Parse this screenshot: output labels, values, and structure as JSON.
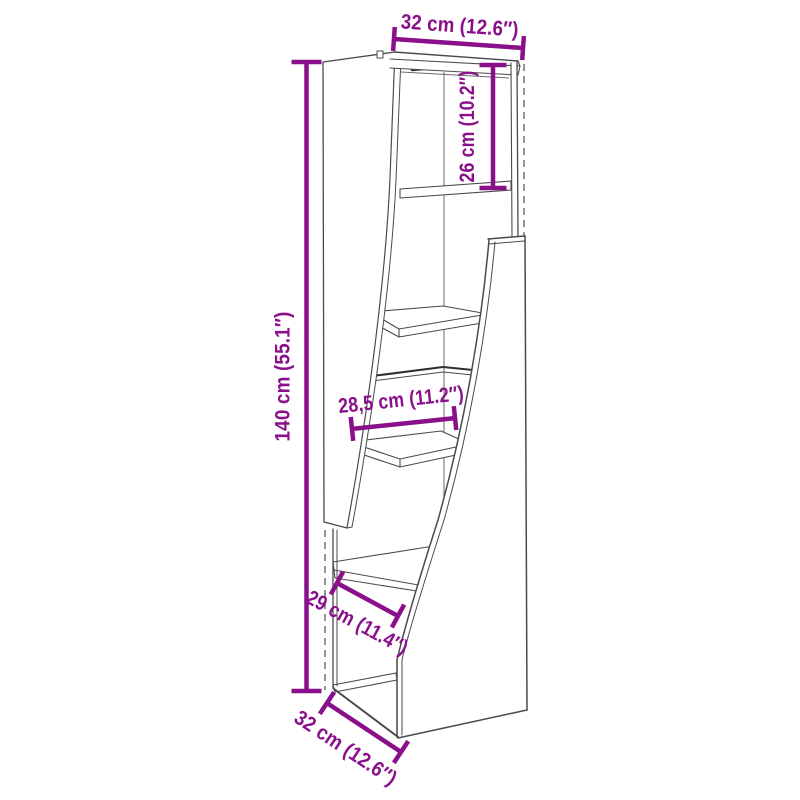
{
  "image_type": "furniture-dimension-diagram",
  "subject": "corner-shelf-unit-line-drawing",
  "colors": {
    "dimension": "#8A0F8A",
    "structure": "#4A4A4A",
    "background": "#FFFFFF"
  },
  "dimensions": {
    "top_width": {
      "label": "32 cm (12.6″)",
      "cm": "32",
      "inches": "12.6"
    },
    "upper_height": {
      "label": "26 cm (10.2″)",
      "cm": "26",
      "inches": "10.2"
    },
    "total_height": {
      "label": "140 cm (55.1″)",
      "cm": "140",
      "inches": "55.1"
    },
    "middle_shelf": {
      "label": "28,5 cm (11.2″)",
      "cm": "28,5",
      "inches": "11.2"
    },
    "lower_shelf": {
      "label": "29 cm (11.4″)",
      "cm": "29",
      "inches": "11.4"
    },
    "bottom_depth": {
      "label": "32 cm (12.6″)",
      "cm": "32",
      "inches": "12.6"
    }
  }
}
